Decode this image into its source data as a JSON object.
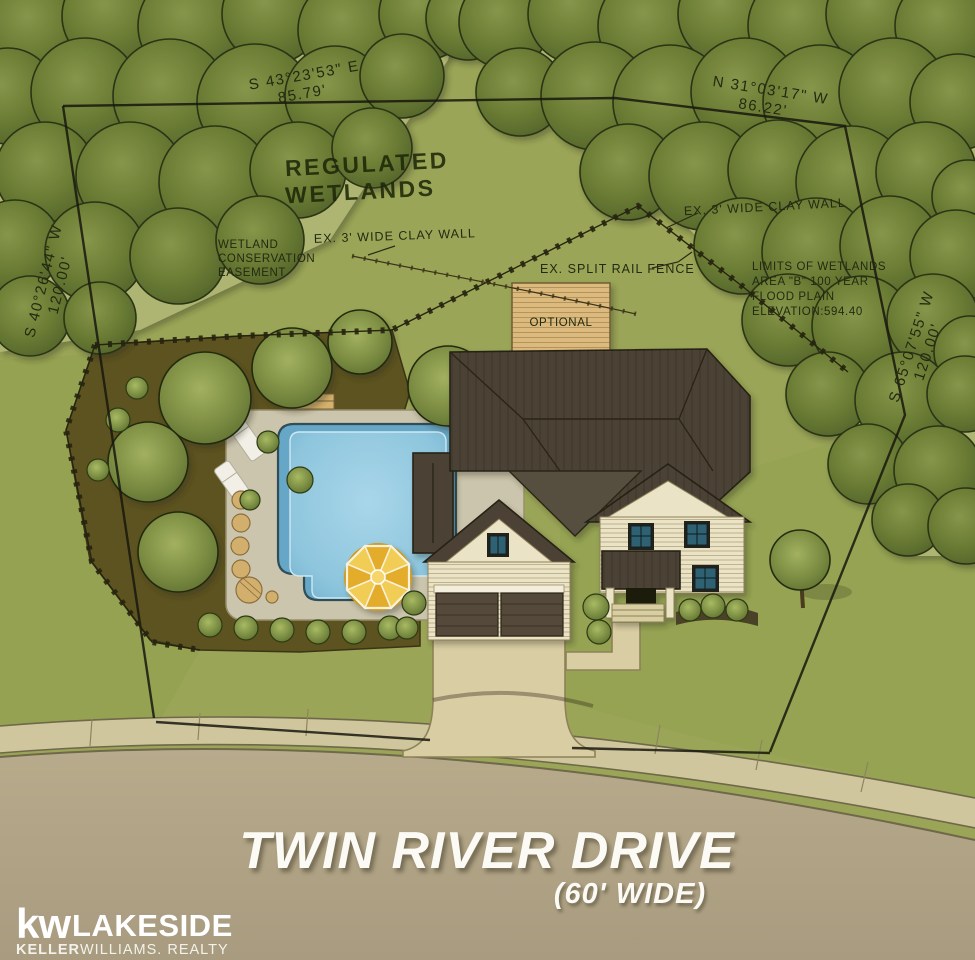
{
  "labels": {
    "regulated_wetlands": {
      "line1": "REGULATED",
      "line2": "WETLANDS"
    },
    "bearing_top_left": {
      "bearing": "S 43°23'53\" E",
      "distance": "85.79'"
    },
    "bearing_top_right": {
      "bearing": "N 31°03'17\" W",
      "distance": "86.22'"
    },
    "bearing_left": {
      "bearing": "S 40°26'44\" W",
      "distance": "120.00'"
    },
    "bearing_right": {
      "bearing": "S 65°07'55\" W",
      "distance": "120.00'"
    },
    "clay_wall_left": "EX. 3' WIDE CLAY WALL",
    "clay_wall_right": "EX. 3' WIDE CLAY WALL",
    "split_rail_fence": "EX. SPLIT RAIL FENCE",
    "wetland_easement": {
      "line1": "WETLAND",
      "line2": "CONSERVATION",
      "line3": "EASEMENT"
    },
    "wetland_limits": {
      "line1": "LIMITS OF WETLANDS",
      "line2": "AREA \"B\" 100 YEAR",
      "line3": "FLOOD PLAIN",
      "line4": "ELEVATION:594.40"
    },
    "deck": "OPTIONAL"
  },
  "street": {
    "name": "TWIN RIVER DRIVE",
    "width_note": "(60' WIDE)"
  },
  "logo": {
    "mark": "kw",
    "brand": "LAKESIDE",
    "sub_bold": "KELLER",
    "sub_rest": "WILLIAMS. REALTY"
  },
  "colors": {
    "grass": "#9aa557",
    "street": "#b2a586",
    "sidewalk": "#cfc69e",
    "mulch": "#5d5320",
    "patio": "#ccc5ad",
    "pool": "#8ec6dd",
    "roof": "#4b4334",
    "siding": "#eae3c5",
    "window_glass": "#2f6272",
    "ink": "#232a11",
    "street_text": "#fbfaf4",
    "umbrella": "#e3ac2a"
  }
}
